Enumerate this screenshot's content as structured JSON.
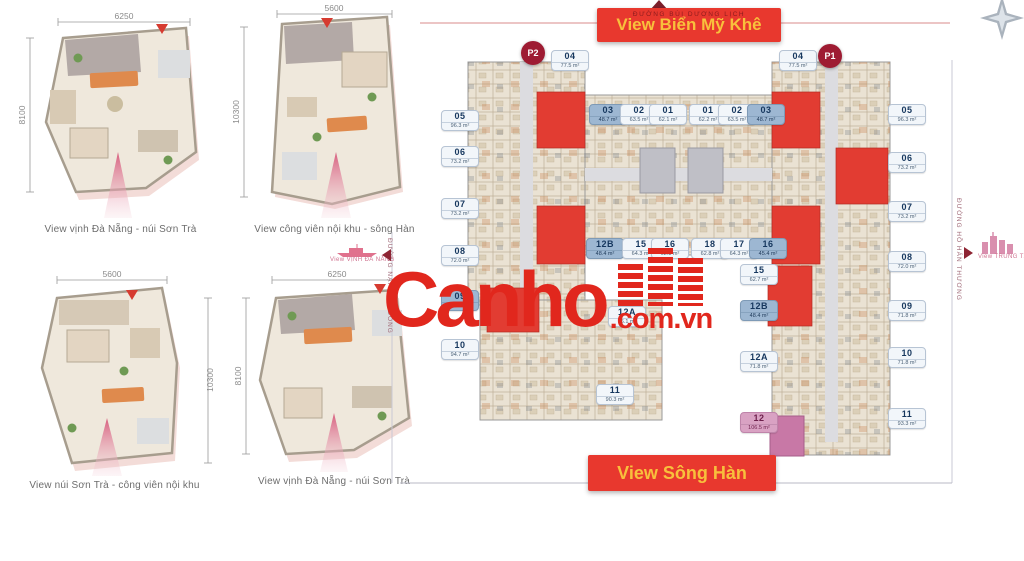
{
  "banners": {
    "top": "View Biển Mỹ Khê",
    "bottom": "View Sông Hàn"
  },
  "streets": {
    "top": "ĐƯỜNG BÙI DƯƠNG LỊCH",
    "right": "ĐƯỜNG HỒ HÁN THƯƠNG",
    "left": "ĐƯỜNG NẠI HIÊN ĐÔNG"
  },
  "edge_views": {
    "left": "View VỊNH ĐÀ NẴNG",
    "right": "View TRUNG TÂM"
  },
  "badges": {
    "p2": "P2",
    "p1": "P1"
  },
  "watermark": {
    "brand": "Canho",
    "suffix": ".com.vn"
  },
  "colors": {
    "banner_red": "#e8382e",
    "banner_text": "#f8c03c",
    "badge": "#9e1b32",
    "unit_red": "#e23c32",
    "unit_pink": "#c878a6",
    "chip_highlight": "#9db7d2",
    "watermark_red": "#e1271d"
  },
  "apartments": [
    {
      "caption": "View vịnh Đà Nẵng - núi Sơn Trà",
      "dim_top": "6250",
      "dim_side": "8100",
      "side": "left"
    },
    {
      "caption": "View công viên nội khu - sông Hàn",
      "dim_top": "5600",
      "dim_side": "10300",
      "side": "left"
    },
    {
      "caption": "View núi Sơn Trà - công viên nội khu",
      "dim_top": "5600",
      "dim_side": "10300",
      "side": "right"
    },
    {
      "caption": "View vịnh Đà Nẵng - núi Sơn Trà",
      "dim_top": "6250",
      "dim_side": "8100",
      "side": "left"
    }
  ],
  "plan": {
    "units": [
      {
        "id": "05",
        "area": "96.3 m²",
        "x": 441,
        "y": 110,
        "v": ""
      },
      {
        "id": "06",
        "area": "73.2 m²",
        "x": 441,
        "y": 146,
        "v": ""
      },
      {
        "id": "07",
        "area": "73.2 m²",
        "x": 441,
        "y": 198,
        "v": ""
      },
      {
        "id": "08",
        "area": "72.0 m²",
        "x": 441,
        "y": 245,
        "v": ""
      },
      {
        "id": "09",
        "area": "80.7 m²",
        "x": 441,
        "y": 290,
        "v": "hl"
      },
      {
        "id": "10",
        "area": "94.7 m²",
        "x": 441,
        "y": 339,
        "v": ""
      },
      {
        "id": "11",
        "area": "90.3 m²",
        "x": 596,
        "y": 384,
        "v": ""
      },
      {
        "id": "04",
        "area": "77.5 m²",
        "x": 551,
        "y": 50,
        "v": ""
      },
      {
        "id": "03",
        "area": "48.7 m²",
        "x": 589,
        "y": 104,
        "v": "hl"
      },
      {
        "id": "02",
        "area": "63.5 m²",
        "x": 620,
        "y": 104,
        "v": ""
      },
      {
        "id": "01",
        "area": "62.1 m²",
        "x": 649,
        "y": 104,
        "v": ""
      },
      {
        "id": "01",
        "area": "62.2 m²",
        "x": 689,
        "y": 104,
        "v": ""
      },
      {
        "id": "02",
        "area": "63.5 m²",
        "x": 718,
        "y": 104,
        "v": ""
      },
      {
        "id": "03",
        "area": "48.7 m²",
        "x": 747,
        "y": 104,
        "v": "hl"
      },
      {
        "id": "04",
        "area": "77.5 m²",
        "x": 779,
        "y": 50,
        "v": ""
      },
      {
        "id": "12B",
        "area": "48.4 m²",
        "x": 586,
        "y": 238,
        "v": "hl"
      },
      {
        "id": "15",
        "area": "64.3 m²",
        "x": 622,
        "y": 238,
        "v": ""
      },
      {
        "id": "16",
        "area": "62.8 m²",
        "x": 651,
        "y": 238,
        "v": ""
      },
      {
        "id": "18",
        "area": "62.8 m²",
        "x": 691,
        "y": 238,
        "v": ""
      },
      {
        "id": "17",
        "area": "64.3 m²",
        "x": 720,
        "y": 238,
        "v": ""
      },
      {
        "id": "16",
        "area": "45.4 m²",
        "x": 749,
        "y": 238,
        "v": "hl"
      },
      {
        "id": "12A",
        "area": "76.1 m²",
        "x": 608,
        "y": 306,
        "v": ""
      },
      {
        "id": "15",
        "area": "62.7 m²",
        "x": 740,
        "y": 264,
        "v": ""
      },
      {
        "id": "12B",
        "area": "48.4 m²",
        "x": 740,
        "y": 300,
        "v": "hl"
      },
      {
        "id": "12A",
        "area": "71.8 m²",
        "x": 740,
        "y": 351,
        "v": ""
      },
      {
        "id": "12",
        "area": "106.5 m²",
        "x": 740,
        "y": 412,
        "v": "pink"
      },
      {
        "id": "05",
        "area": "96.3 m²",
        "x": 888,
        "y": 104,
        "v": ""
      },
      {
        "id": "06",
        "area": "73.2 m²",
        "x": 888,
        "y": 152,
        "v": ""
      },
      {
        "id": "07",
        "area": "73.2 m²",
        "x": 888,
        "y": 201,
        "v": ""
      },
      {
        "id": "08",
        "area": "72.0 m²",
        "x": 888,
        "y": 251,
        "v": ""
      },
      {
        "id": "09",
        "area": "71.8 m²",
        "x": 888,
        "y": 300,
        "v": ""
      },
      {
        "id": "10",
        "area": "71.8 m²",
        "x": 888,
        "y": 347,
        "v": ""
      },
      {
        "id": "11",
        "area": "93.3 m²",
        "x": 888,
        "y": 408,
        "v": ""
      }
    ]
  }
}
